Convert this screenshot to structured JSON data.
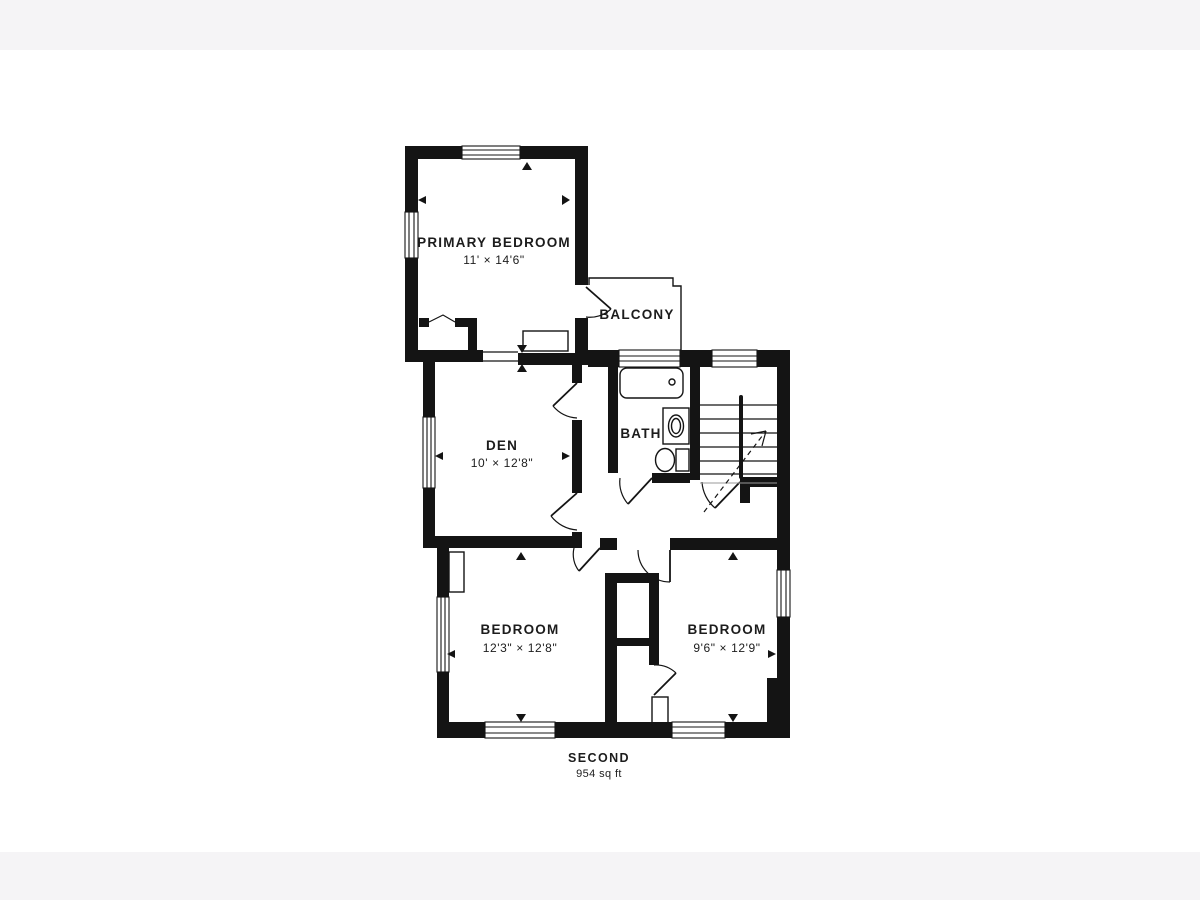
{
  "floorplan": {
    "title": "SECOND",
    "area": "954 sq ft",
    "rooms": [
      {
        "id": "primary-bedroom",
        "name": "PRIMARY BEDROOM",
        "dims": "11' × 14'6\""
      },
      {
        "id": "balcony",
        "name": "BALCONY",
        "dims": ""
      },
      {
        "id": "den",
        "name": "DEN",
        "dims": "10' × 12'8\""
      },
      {
        "id": "bath",
        "name": "BATH",
        "dims": ""
      },
      {
        "id": "bedroom-left",
        "name": "BEDROOM",
        "dims": "12'3\" × 12'8\""
      },
      {
        "id": "bedroom-right",
        "name": "BEDROOM",
        "dims": "9'6\" × 12'9\""
      }
    ],
    "features": [
      "bathtub",
      "sink",
      "toilet",
      "staircase",
      "railing",
      "balcony",
      "closet",
      "windows",
      "door-swings"
    ],
    "colors": {
      "walls": "#141414",
      "background": "#ffffff",
      "letterbox": "#f5f4f6",
      "text": "#1c1c1c"
    }
  }
}
